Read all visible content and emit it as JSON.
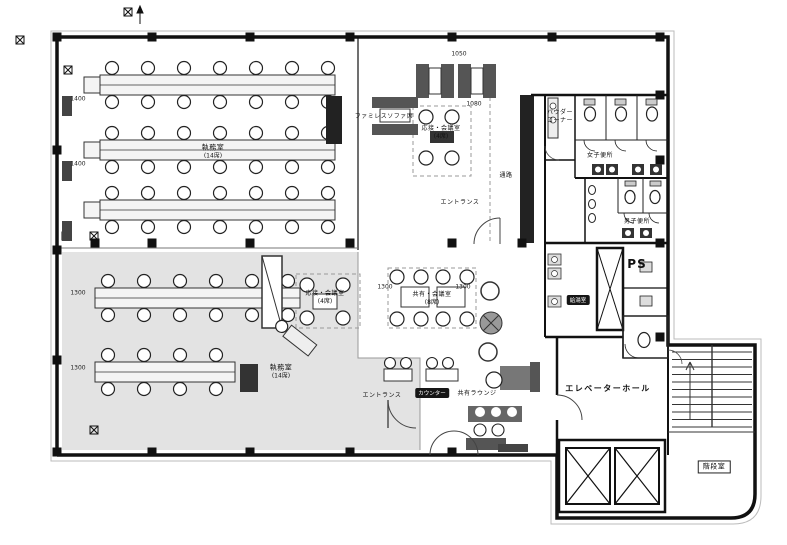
{
  "drawing": {
    "type": "architectural-floor-plan",
    "description": "Japanese office floor fit-out plan with shaded open-office zone, shared meeting areas, lounge, toilets, elevator hall and stair room"
  },
  "colors": {
    "wall": "#111111",
    "shaded_zone": "#dcdcdc",
    "furniture_dark": "#555555",
    "paper": "#ffffff"
  },
  "rooms": {
    "office_upper": {
      "label": "執務室",
      "seats": "(14席)"
    },
    "office_lower": {
      "label": "執務室",
      "seats": "(14席)"
    },
    "family_sofa": {
      "label": "ファミレスソファ席"
    },
    "meeting_upper": {
      "label": "応接・会議室",
      "seats": "(4席)"
    },
    "entrance_upper": {
      "label": "エントランス"
    },
    "corridor": {
      "label": "通路"
    },
    "powder_corner": {
      "line1": "パウダー",
      "line2": "コーナー"
    },
    "wc_women": {
      "label": "女子便所"
    },
    "wc_men": {
      "label": "男子便所"
    },
    "pipe_shaft": {
      "label": "PS"
    },
    "kitchenette": {
      "label": "給湯室"
    },
    "meeting_lower": {
      "label": "応接・会議室",
      "seats": "(4席)"
    },
    "meeting_shared": {
      "label": "共有・会議室",
      "seats": "(8席)"
    },
    "entrance_lower": {
      "label": "エントランス"
    },
    "counter_tag": {
      "label": "カウンター"
    },
    "lounge": {
      "label": "共有ラウンジ"
    },
    "elevator_hall": {
      "label": "エレベーターホール"
    },
    "stair_room": {
      "label": "階段室"
    }
  },
  "dimensions": [
    {
      "text": "1400",
      "x": 78,
      "y": 99
    },
    {
      "text": "1400",
      "x": 78,
      "y": 164
    },
    {
      "text": "1300",
      "x": 78,
      "y": 293
    },
    {
      "text": "1300",
      "x": 78,
      "y": 368
    },
    {
      "text": "1050",
      "x": 459,
      "y": 54
    },
    {
      "text": "1080",
      "x": 474,
      "y": 104
    },
    {
      "text": "1300",
      "x": 385,
      "y": 287
    },
    {
      "text": "1300",
      "x": 463,
      "y": 287
    }
  ]
}
